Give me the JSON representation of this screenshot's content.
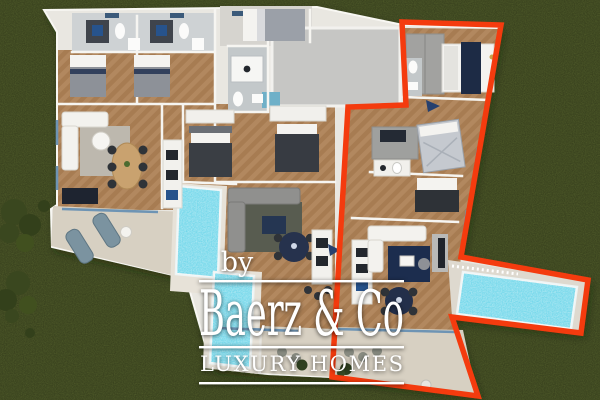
{
  "watermark": {
    "prefix": "by",
    "brand": "Baerz & Co",
    "tagline": "LUXURY HOMES"
  },
  "palette": {
    "grass": "#57642e",
    "bush": "#3a471f",
    "red_outline": "#f43b0e",
    "pool_water": "#55cfe6",
    "wood_floor": "#b2885f",
    "tile_floor": "#ccd0d2",
    "terrace": "#d7d0c2",
    "wall_white": "#e9e7e1",
    "furniture_dark": "#343b46",
    "navy_accent": "#22314f",
    "watermark_text": "#ffffff"
  },
  "scene": {
    "description": "Top-down 3D floor plan render of a villa on a lawn; right-hand unit outlined in red",
    "pools_count": "3",
    "sun_loungers_count": "2"
  }
}
